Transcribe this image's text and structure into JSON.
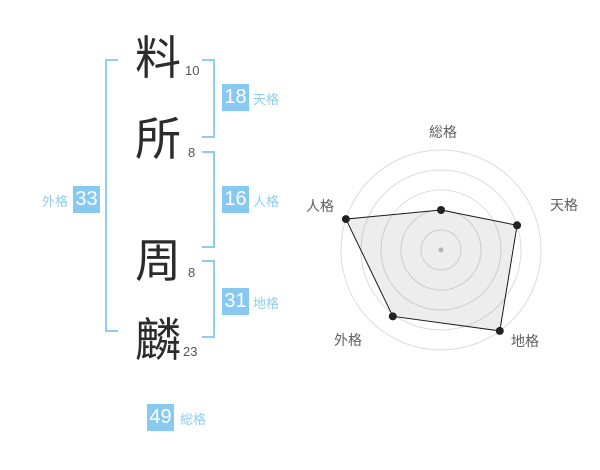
{
  "name_panel": {
    "characters": [
      {
        "char": "料",
        "strokes": "10"
      },
      {
        "char": "所",
        "strokes": "8"
      },
      {
        "char": "周",
        "strokes": "8"
      },
      {
        "char": "麟",
        "strokes": "23"
      }
    ],
    "scores": {
      "tenkaku": {
        "value": "18",
        "label": "天格"
      },
      "jinkaku": {
        "value": "16",
        "label": "人格"
      },
      "chikaku": {
        "value": "31",
        "label": "地格"
      },
      "gaikaku": {
        "value": "33",
        "label": "外格"
      },
      "soukaku": {
        "value": "49",
        "label": "総格"
      }
    },
    "colors": {
      "badge_background": "#87c9f0",
      "badge_text": "#ffffff",
      "label_text": "#8fcdf2",
      "bracket": "#8fcdf2",
      "character_text": "#2b2b2b",
      "stroke_count_text": "#555555"
    }
  },
  "chart_data": {
    "type": "radar",
    "axes": [
      "総格",
      "天格",
      "地格",
      "外格",
      "人格"
    ],
    "values_fraction_of_max": [
      0.4,
      0.8,
      1.0,
      0.82,
      1.0
    ],
    "rings": 5,
    "grid": "concentric-circles",
    "legend": "none",
    "colors": {
      "grid": "#dcdcdc",
      "outline": "#1a1a1a",
      "fill": "rgba(0,0,0,0.07)",
      "vertex_point": "#222222",
      "center_dot": "#c4c4c4",
      "axis_label": "#5f5f5f"
    }
  }
}
